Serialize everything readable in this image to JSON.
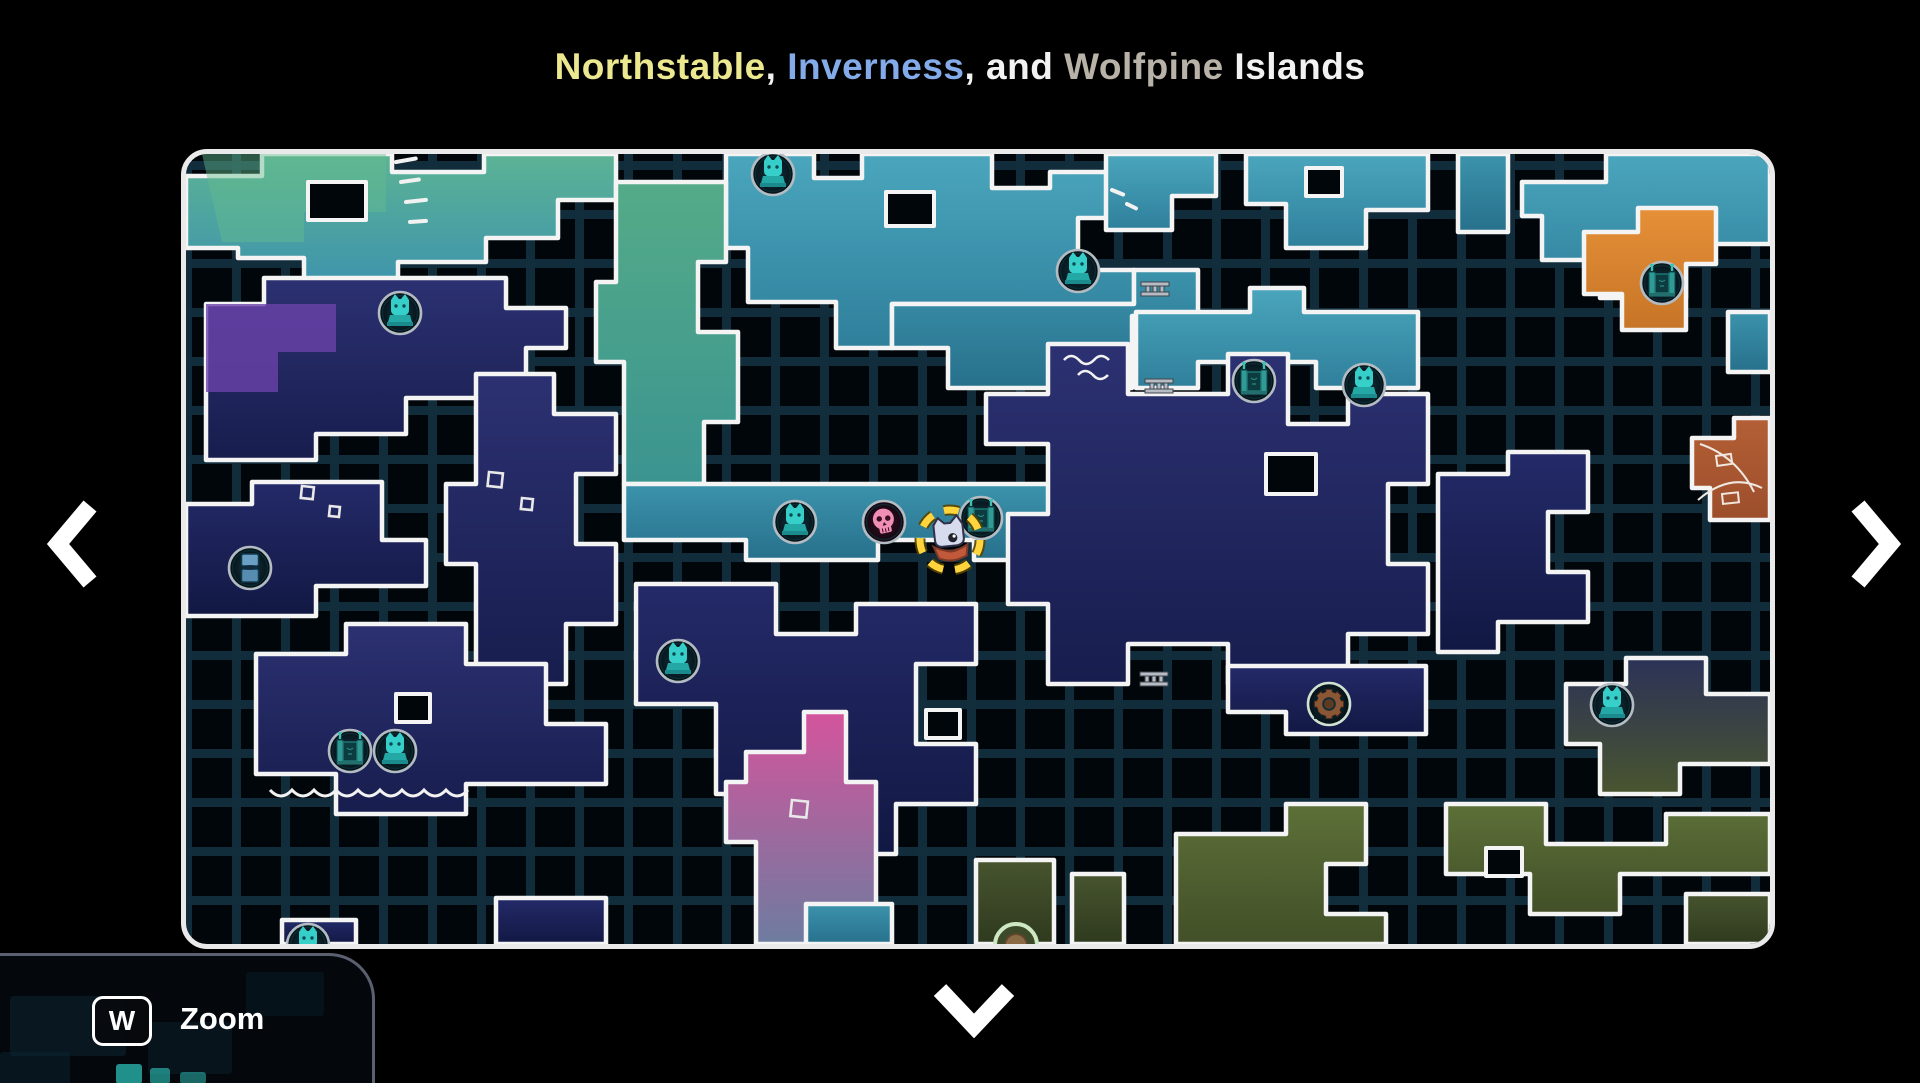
{
  "title": {
    "segments": [
      {
        "text": "Northstable",
        "color": "#ece88f"
      },
      {
        "text": ", ",
        "color": "#f2f2f2"
      },
      {
        "text": "Inverness",
        "color": "#84abe9"
      },
      {
        "text": ", and ",
        "color": "#f2f2f2"
      },
      {
        "text": "Wolfpine",
        "color": "#b8b2a8"
      },
      {
        "text": " Islands",
        "color": "#f2f2f2"
      }
    ]
  },
  "nav": {
    "left_icon": "chevron-left",
    "right_icon": "chevron-right",
    "down_icon": "chevron-down"
  },
  "hotkey": {
    "key": "W",
    "label": "Zoom"
  },
  "map": {
    "background": "#01060a",
    "grid_color": "#122e3d",
    "outline_color": "#f4f4f4",
    "border_color": "#eaeaea",
    "player_ring_color": "#ffd43c",
    "gradients": [
      {
        "id": "gTealGreen",
        "type": "linear",
        "from": "#5cb394",
        "to": "#3e94ac"
      },
      {
        "id": "gTeal",
        "type": "linear",
        "from": "#4aa6bd",
        "to": "#2f7f9b"
      },
      {
        "id": "gTealDeep",
        "type": "linear",
        "from": "#3c93ac",
        "to": "#27708c"
      },
      {
        "id": "gSeagreen",
        "type": "linear",
        "from": "#54ab88",
        "to": "#3b9490"
      },
      {
        "id": "gNavy",
        "type": "linear",
        "from": "#2c3172",
        "to": "#171d4d"
      },
      {
        "id": "gNavyDeep",
        "type": "linear",
        "from": "#242a68",
        "to": "#121843"
      },
      {
        "id": "gPink",
        "type": "linear",
        "from": "#d4549c",
        "to": "#6d7ca0"
      },
      {
        "id": "gOlive",
        "type": "linear",
        "from": "#5d7038",
        "to": "#424f28"
      },
      {
        "id": "gOliveDark",
        "type": "linear",
        "from": "#47542e",
        "to": "#2f3a1e"
      },
      {
        "id": "gOrange",
        "type": "linear",
        "from": "#e69038",
        "to": "#c67426"
      },
      {
        "id": "gRust",
        "type": "linear",
        "from": "#b45f36",
        "to": "#9c4e2b"
      },
      {
        "id": "gNavyOlive",
        "type": "linear",
        "from": "#2c3258",
        "to": "#49552f"
      },
      {
        "id": "gIconBg",
        "type": "radial",
        "from": "#123642",
        "to": "#060f15"
      },
      {
        "id": "gIconBgPink",
        "type": "radial",
        "from": "#33101f",
        "to": "#140611"
      }
    ],
    "shapes": [
      {
        "name": "top-left-band",
        "path": "M0,22 H76 V0 H206 V18 H298 V0 H430 V46 H372 V84 H300 V108 H212 V130 H118 V104 H52 V94 H0 Z",
        "fill": "gTealGreen"
      },
      {
        "name": "top-left-green-patch",
        "path": "M16,0 H200 V58 H118 V88 H36 Z",
        "fill": "#64bc8e",
        "opacity": 0.45,
        "stroke": false
      },
      {
        "name": "top-center-mass",
        "path": "M540,0 H628 V24 H676 V0 H806 V34 H864 V18 H948 V64 H892 V116 H948 V150 H706 V194 H650 V148 H562 V94 H540 Z",
        "fill": "gTeal"
      },
      {
        "name": "wave-row",
        "path": "M706,150 H948 V116 H1012 V162 H946 V234 H762 V194 H706 Z",
        "fill": "gTealDeep"
      },
      {
        "name": "bridge-row",
        "path": "M950,158 H1064 V134 H1118 V158 H1232 V234 H1130 V208 H1012 V234 H950 Z",
        "fill": "gTeal"
      },
      {
        "name": "top-right-a",
        "path": "M920,0 H1030 V42 H986 V76 H920 Z",
        "fill": "gTeal"
      },
      {
        "name": "top-right-b",
        "path": "M1060,0 H1242 V56 H1180 V94 H1100 V50 H1060 Z",
        "fill": "gTeal"
      },
      {
        "name": "top-right-c",
        "path": "M1272,0 H1322 V78 H1272 Z",
        "fill": "gTealDeep"
      },
      {
        "name": "far-right-top",
        "path": "M1336,28 H1420 V0 H1584 V90 H1500 V144 H1414 V106 H1356 V62 H1336 Z",
        "fill": "gTeal"
      },
      {
        "name": "far-right-small",
        "path": "M1542,158 H1584 V218 H1542 Z",
        "fill": "gTealDeep"
      },
      {
        "name": "orange-outpost",
        "path": "M1398,78 H1452 V54 H1530 V110 H1500 V176 H1436 V140 H1398 Z",
        "fill": "gOrange"
      },
      {
        "name": "rust-grove",
        "path": "M1506,284 H1548 V264 H1584 V366 H1524 V334 H1506 Z",
        "fill": "gRust"
      },
      {
        "name": "seagreen-column",
        "path": "M430,28 H540 V108 H512 V178 H552 V268 H518 V330 H438 V208 H410 V128 H430 Z",
        "fill": "gSeagreen"
      },
      {
        "name": "center-row",
        "path": "M438,330 H910 V406 H788 V386 H692 V406 H560 V386 H438 Z",
        "fill": "gTealDeep"
      },
      {
        "name": "left-navy-isle",
        "path": "M20,150 H78 V124 H320 V154 H380 V194 H340 V244 H220 V280 H130 V306 H20 Z",
        "fill": "gNavy"
      },
      {
        "name": "purple-patch",
        "path": "M20,150 H150 V198 H92 V238 H20 Z",
        "fill": "#6b42aa",
        "opacity": 0.8,
        "stroke": false
      },
      {
        "name": "left-mid-navy",
        "path": "M0,350 H66 V328 H196 V386 H240 V432 H130 V462 H0 Z",
        "fill": "gNavyDeep"
      },
      {
        "name": "center-left-tower",
        "path": "M290,220 H368 V260 H430 V320 H390 V390 H430 V470 H380 V530 H290 V410 H260 V330 H290 Z",
        "fill": "gNavy"
      },
      {
        "name": "center-navy-maze",
        "path": "M450,430 H590 V480 H670 V450 H790 V510 H730 V590 H790 V650 H710 V700 H590 V640 H530 V550 H450 Z",
        "fill": "gNavyDeep"
      },
      {
        "name": "bottom-left-navy",
        "path": "M70,500 H160 V470 H280 V510 H360 V570 H420 V630 H280 V660 H150 V620 H70 Z",
        "fill": "gNavy"
      },
      {
        "name": "pink-hollow",
        "path": "M560,598 H618 V558 H660 V628 H690 V790 H570 V688 H540 V628 H560 Z",
        "fill": "gPink"
      },
      {
        "name": "center-right-castle",
        "path": "M800,240 H862 V190 H942 V240 H1042 V200 H1102 V270 H1162 V240 H1242 V330 H1202 V410 H1242 V480 H1162 V530 H1042 V490 H942 V530 H862 V450 H822 V360 H862 V290 H800 Z",
        "fill": "gNavy"
      },
      {
        "name": "gear-arm",
        "path": "M1042,512 H1240 V580 H1100 V558 H1042 Z",
        "fill": "gNavyDeep"
      },
      {
        "name": "right-navy",
        "path": "M1252,320 H1322 V298 H1402 V358 H1362 V418 H1402 V468 H1312 V498 H1252 Z",
        "fill": "gNavyDeep"
      },
      {
        "name": "bottom-right-ridge",
        "path": "M1380,530 H1440 V504 H1520 V540 H1584 V610 H1494 V640 H1414 V590 H1380 Z",
        "fill": "gNavyOlive"
      },
      {
        "name": "olive-maze-a",
        "path": "M990,680 H1100 V650 H1180 V710 H1140 V760 H1200 V790 H990 Z",
        "fill": "gOlive"
      },
      {
        "name": "olive-maze-b",
        "path": "M1260,650 H1360 V690 H1480 V660 H1584 V720 H1434 V760 H1344 V720 H1260 Z",
        "fill": "gOlive"
      },
      {
        "name": "olive-strip",
        "path": "M1500,740 H1584 V790 H1500 Z",
        "fill": "gOliveDark"
      },
      {
        "name": "bottom-center-olive-a",
        "path": "M790,706 H868 V790 H790 Z",
        "fill": "gOliveDark"
      },
      {
        "name": "bottom-center-olive-b",
        "path": "M886,720 H938 V790 H886 Z",
        "fill": "gOliveDark"
      },
      {
        "name": "bottom-left-clip",
        "path": "M96,766 H170 V790 H96 Z",
        "fill": "gNavyDeep"
      },
      {
        "name": "bottom-center-teal",
        "path": "M620,750 H706 V790 H620 Z",
        "fill": "gTealDeep"
      },
      {
        "name": "bottom-navy-clip",
        "path": "M310,744 H420 V790 H310 Z",
        "fill": "gNavyDeep"
      }
    ],
    "holes": [
      {
        "path": "M122,28 H180 V66 H122 Z"
      },
      {
        "path": "M700,38 H748 V72 H700 Z"
      },
      {
        "path": "M1120,14 H1156 V42 H1120 Z"
      },
      {
        "path": "M1080,300 H1130 V340 H1080 Z"
      },
      {
        "path": "M1300,694 H1336 V722 H1300 Z"
      },
      {
        "path": "M210,540 H244 V568 H210 Z"
      },
      {
        "path": "M740,556 H774 V584 H740 Z"
      }
    ],
    "decorations": [
      {
        "type": "dash",
        "x": 210,
        "y": 8,
        "len": 20,
        "rot": -10
      },
      {
        "type": "dash",
        "x": 215,
        "y": 28,
        "len": 18,
        "rot": -8
      },
      {
        "type": "dash",
        "x": 220,
        "y": 48,
        "len": 20,
        "rot": -6
      },
      {
        "type": "dash",
        "x": 224,
        "y": 68,
        "len": 16,
        "rot": -4
      },
      {
        "type": "dash",
        "x": 926,
        "y": 36,
        "len": 12,
        "rot": 22
      },
      {
        "type": "dash",
        "x": 941,
        "y": 50,
        "len": 10,
        "rot": 26
      },
      {
        "type": "wave",
        "x": 878,
        "y": 206,
        "w": 46
      },
      {
        "type": "wave",
        "x": 892,
        "y": 221,
        "w": 30
      },
      {
        "type": "square",
        "x": 303,
        "y": 318,
        "s": 14
      },
      {
        "type": "square",
        "x": 336,
        "y": 344,
        "s": 11
      },
      {
        "type": "square",
        "x": 116,
        "y": 332,
        "s": 12
      },
      {
        "type": "square",
        "x": 144,
        "y": 352,
        "s": 10
      },
      {
        "type": "square",
        "x": 606,
        "y": 646,
        "s": 16
      },
      {
        "type": "waterline",
        "x": 84,
        "y": 636,
        "w": 190
      },
      {
        "type": "sketch",
        "x": 1506,
        "y": 284
      }
    ],
    "icons": [
      {
        "type": "statue",
        "x": 587,
        "y": 20
      },
      {
        "type": "statue",
        "x": 892,
        "y": 117
      },
      {
        "type": "gate",
        "x": 1068,
        "y": 227
      },
      {
        "type": "statue",
        "x": 1178,
        "y": 231
      },
      {
        "type": "gate",
        "x": 1476,
        "y": 129
      },
      {
        "type": "statue",
        "x": 214,
        "y": 159
      },
      {
        "type": "pillar",
        "x": 64,
        "y": 414
      },
      {
        "type": "statue",
        "x": 492,
        "y": 507
      },
      {
        "type": "gate",
        "x": 164,
        "y": 597
      },
      {
        "type": "statue",
        "x": 209,
        "y": 597
      },
      {
        "type": "statue",
        "x": 609,
        "y": 368
      },
      {
        "type": "skull",
        "x": 698,
        "y": 368
      },
      {
        "type": "gate",
        "x": 795,
        "y": 364
      },
      {
        "type": "gear",
        "x": 1143,
        "y": 550
      },
      {
        "type": "statue",
        "x": 1426,
        "y": 551
      },
      {
        "type": "statue",
        "x": 122,
        "y": 791
      },
      {
        "type": "gear2",
        "x": 830,
        "y": 791
      },
      {
        "type": "bridge",
        "x": 969,
        "y": 135
      },
      {
        "type": "bridge",
        "x": 973,
        "y": 232
      },
      {
        "type": "bridge",
        "x": 968,
        "y": 525
      },
      {
        "type": "player",
        "x": 764,
        "y": 386
      }
    ]
  },
  "preview": {
    "shapes": [
      {
        "x": 10,
        "y": 40,
        "w": 116,
        "h": 60,
        "fill": "#0c2836",
        "opacity": 0.5
      },
      {
        "x": 148,
        "y": 66,
        "w": 84,
        "h": 52,
        "fill": "#0c2836",
        "opacity": 0.4
      },
      {
        "x": 246,
        "y": 16,
        "w": 78,
        "h": 44,
        "fill": "#0c2836",
        "opacity": 0.35
      },
      {
        "x": 0,
        "y": 96,
        "w": 70,
        "h": 34,
        "fill": "#0c2836",
        "opacity": 0.45
      },
      {
        "x": 116,
        "y": 108,
        "w": 26,
        "h": 20,
        "fill": "#2ec9c0",
        "opacity": 0.7
      },
      {
        "x": 150,
        "y": 112,
        "w": 20,
        "h": 16,
        "fill": "#2ec9c0",
        "opacity": 0.6
      },
      {
        "x": 180,
        "y": 116,
        "w": 26,
        "h": 12,
        "fill": "#2ec9c0",
        "opacity": 0.5
      }
    ]
  }
}
